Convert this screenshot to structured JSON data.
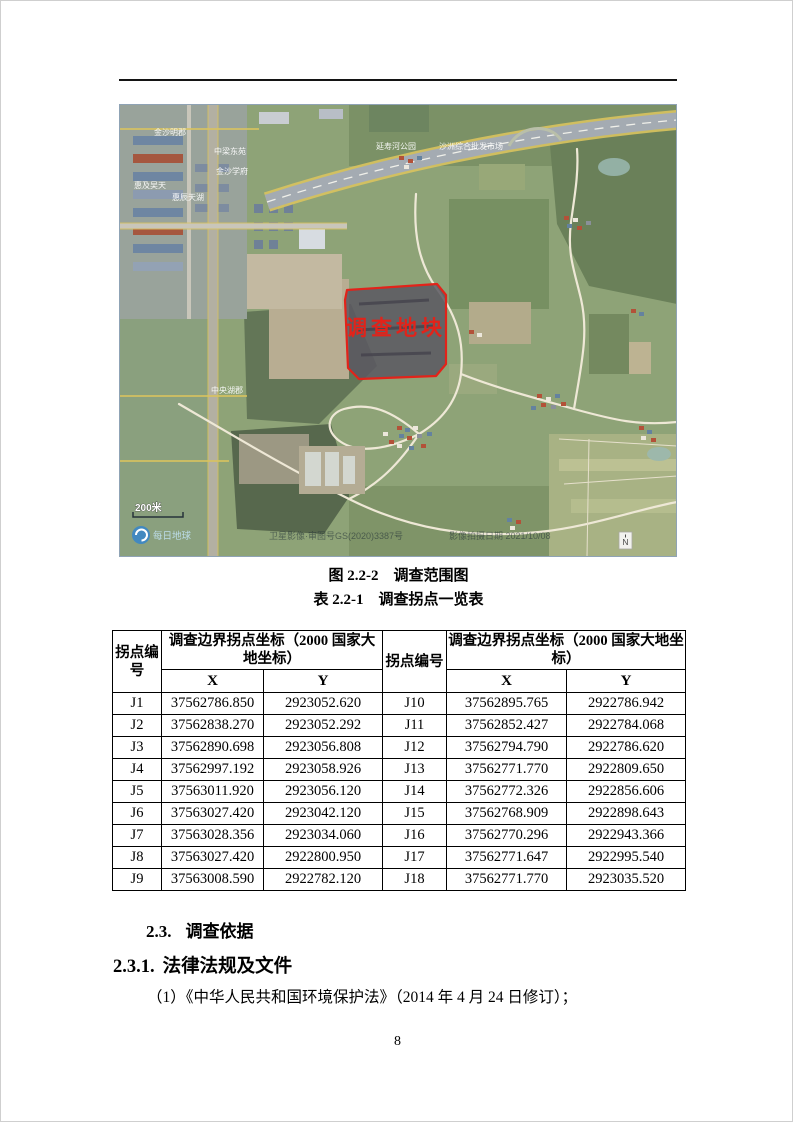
{
  "figure": {
    "caption": "图 2.2-2　调查范围图",
    "map": {
      "plot_label": "调查地块",
      "scale_label": "200米",
      "north_label": "N",
      "logo_text": "每日地球",
      "watermark_center": "卫星影像·审图号GS(2020)3387号",
      "watermark_right": "影像拍摄日期 2021/10/08",
      "place_labels": [
        "金沙明郡",
        "中梁东苑",
        "金沙学府",
        "惠及吴天",
        "惠辰天湖",
        "中央湖郡",
        "延寿河公园",
        "沙洲综合批发市场"
      ]
    }
  },
  "table": {
    "caption": "表 2.2-1　调查拐点一览表",
    "header": {
      "id_left": "拐点编号",
      "coord_left": "调查边界拐点坐标（2000 国家大地坐标）",
      "id_right": "拐点编号",
      "coord_right": "调查边界拐点坐标（2000 国家大地坐标）",
      "x": "X",
      "y": "Y"
    },
    "rows": [
      {
        "id": "J1",
        "x": "37562786.850",
        "y": "2923052.620",
        "id2": "J10",
        "x2": "37562895.765",
        "y2": "2922786.942"
      },
      {
        "id": "J2",
        "x": "37562838.270",
        "y": "2923052.292",
        "id2": "J11",
        "x2": "37562852.427",
        "y2": "2922784.068"
      },
      {
        "id": "J3",
        "x": "37562890.698",
        "y": "2923056.808",
        "id2": "J12",
        "x2": "37562794.790",
        "y2": "2922786.620"
      },
      {
        "id": "J4",
        "x": "37562997.192",
        "y": "2923058.926",
        "id2": "J13",
        "x2": "37562771.770",
        "y2": "2922809.650"
      },
      {
        "id": "J5",
        "x": "37563011.920",
        "y": "2923056.120",
        "id2": "J14",
        "x2": "37562772.326",
        "y2": "2922856.606"
      },
      {
        "id": "J6",
        "x": "37563027.420",
        "y": "2923042.120",
        "id2": "J15",
        "x2": "37562768.909",
        "y2": "2922898.643"
      },
      {
        "id": "J7",
        "x": "37563028.356",
        "y": "2923034.060",
        "id2": "J16",
        "x2": "37562770.296",
        "y2": "2922943.366"
      },
      {
        "id": "J8",
        "x": "37563027.420",
        "y": "2922800.950",
        "id2": "J17",
        "x2": "37562771.647",
        "y2": "2922995.540"
      },
      {
        "id": "J9",
        "x": "37563008.590",
        "y": "2922782.120",
        "id2": "J18",
        "x2": "37562771.770",
        "y2": "2923035.520"
      }
    ]
  },
  "sections": {
    "h23_num": "2.3.",
    "h23_text": "调查依据",
    "h231_num": "2.3.1.",
    "h231_text": "法律法规及文件",
    "para1": "（1）《中华人民共和国环境保护法》（2014 年 4 月 24 日修订）；"
  },
  "page": {
    "number": "8"
  }
}
